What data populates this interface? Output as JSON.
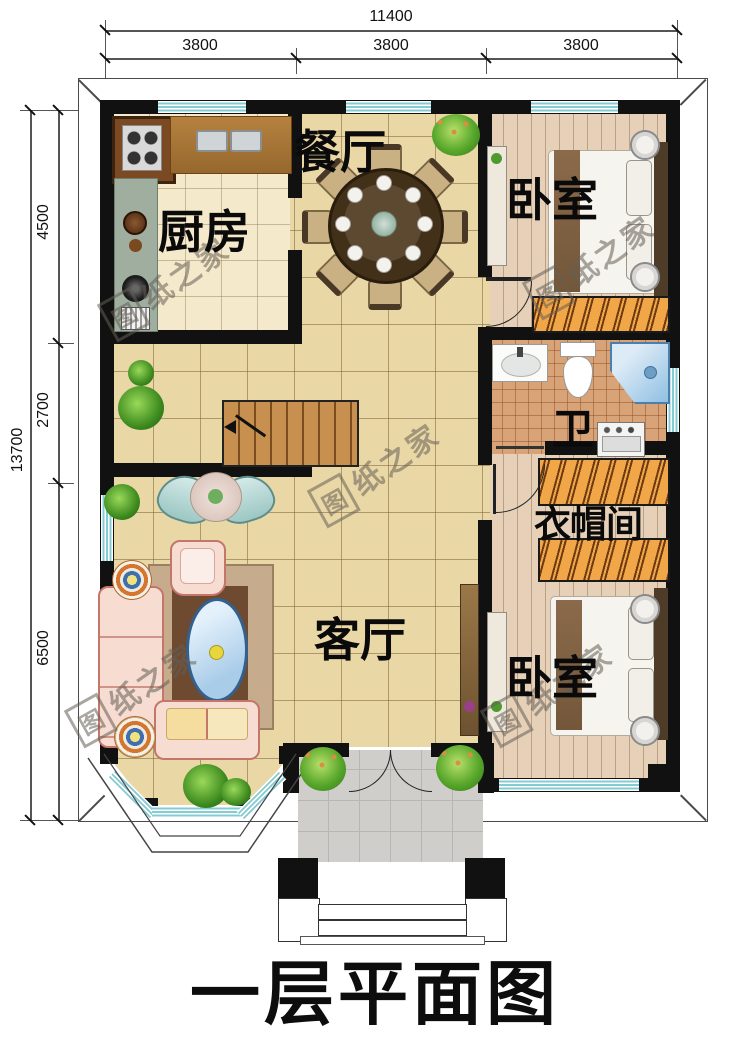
{
  "title": "一层平面图",
  "watermark": {
    "logo": "图",
    "rest": "纸之家"
  },
  "dimensions": {
    "top": {
      "total": "11400",
      "segments": [
        "3800",
        "3800",
        "3800"
      ]
    },
    "left": {
      "total": "13700",
      "segments": [
        "4500",
        "2700",
        "6500"
      ]
    }
  },
  "rooms": {
    "dining": "餐厅",
    "kitchen": "厨房",
    "bedroom_top": "卧室",
    "bathroom": "卫",
    "closet": "衣帽间",
    "living": "客厅",
    "bedroom_bottom": "卧室"
  },
  "colors": {
    "wall": "#111111",
    "window": "#84ccd3",
    "tile": "#ead7a6",
    "wood": "#e6d1b8",
    "wardrobe": "#f1a647",
    "porch": "#cfceca",
    "bath_tile": "#d8a377"
  }
}
